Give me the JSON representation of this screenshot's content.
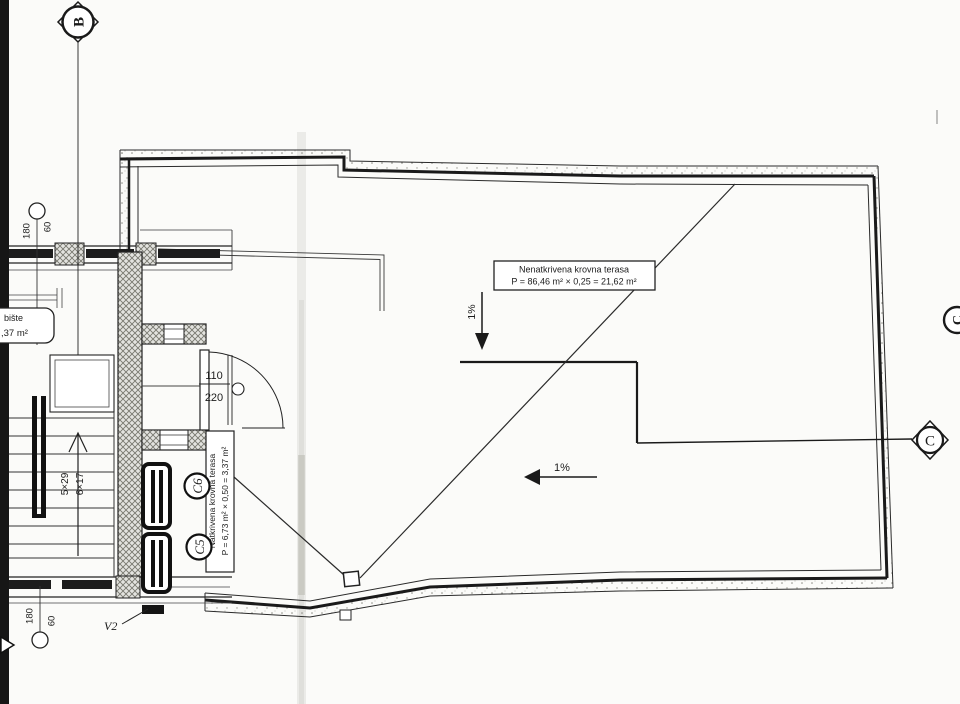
{
  "plan": {
    "grid": {
      "b": "B",
      "c_edge": "C",
      "c_axis": "C"
    },
    "uncovered_label": {
      "title": "Nenatkrivena krovna terasa",
      "calc": "P = 86,46 m² × 0,25 = 21,62 m²"
    },
    "covered_label": {
      "title": "Natkrivena krovna terasa",
      "calc": "P = 6,73 m² × 0,50 = 3,37 m²"
    },
    "stair_label": {
      "title": "bište",
      "calc": ",37 m²"
    },
    "slope_down": "1%",
    "slope_left": "1%",
    "door": {
      "width": "110",
      "height": "220"
    },
    "stairs": {
      "flight_a": "5×29",
      "flight_b": "6×17"
    },
    "dim_top": {
      "a": "180",
      "b": "60"
    },
    "dim_bottom": {
      "a": "180",
      "b": "60"
    },
    "marks": {
      "v2": "V2",
      "c5": "C5",
      "c6": "C6"
    }
  }
}
